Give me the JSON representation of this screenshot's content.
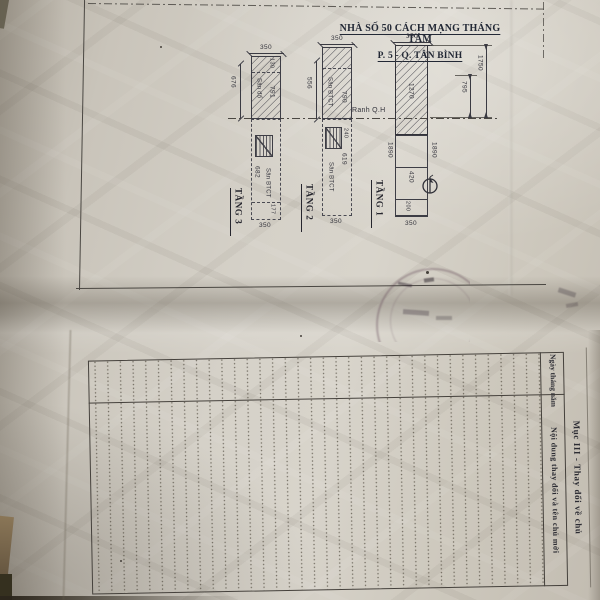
{
  "drawing": {
    "title_line1": "NHÀ SỐ 50 CÁCH MẠNG THÁNG TÁM",
    "title_line2": "P. 5 - Q. TÂN BÌNH",
    "boundary_label": "Ranh Q.H",
    "floor1": {
      "label": "TẦNG 1",
      "width_top": "350",
      "width_bottom": "350",
      "built_dim": "1270",
      "side_dim_left": "1890",
      "side_dim_right": "1890",
      "yard_dim": "420",
      "back_dim": "200",
      "offset_dim": "795",
      "total_dim": "1750"
    },
    "floor2": {
      "label": "TẦNG 2",
      "width_top": "350",
      "width_bottom": "350",
      "height_dim": "556",
      "roof_label": "Sân BTCT",
      "roof_dim": "790",
      "stair_dim": "240",
      "yard_dim": "619",
      "yard_label": "Sân BTCT"
    },
    "floor3": {
      "label": "TẦNG 3",
      "width_top": "350",
      "width_bottom": "350",
      "height_dim": "676",
      "top_cell_dim": "130",
      "roof_label": "Sân đổ",
      "roof_dim": "791",
      "yard_dim": "682",
      "yard_label": "Sân BTCT",
      "back_dim": "177"
    }
  },
  "table": {
    "section_title": "Mục III - Thay đổi về chủ",
    "col_date": "Ngày tháng năm",
    "col_content": "Nội dung thay đổi và tên chủ mới",
    "row_count": 35,
    "rows_empty": true
  },
  "colors": {
    "paper": "#d0cbc1",
    "ink": "#34343c",
    "table_line": "#45413c",
    "stamp": "#5a3e4e",
    "background": "#1d1913"
  }
}
